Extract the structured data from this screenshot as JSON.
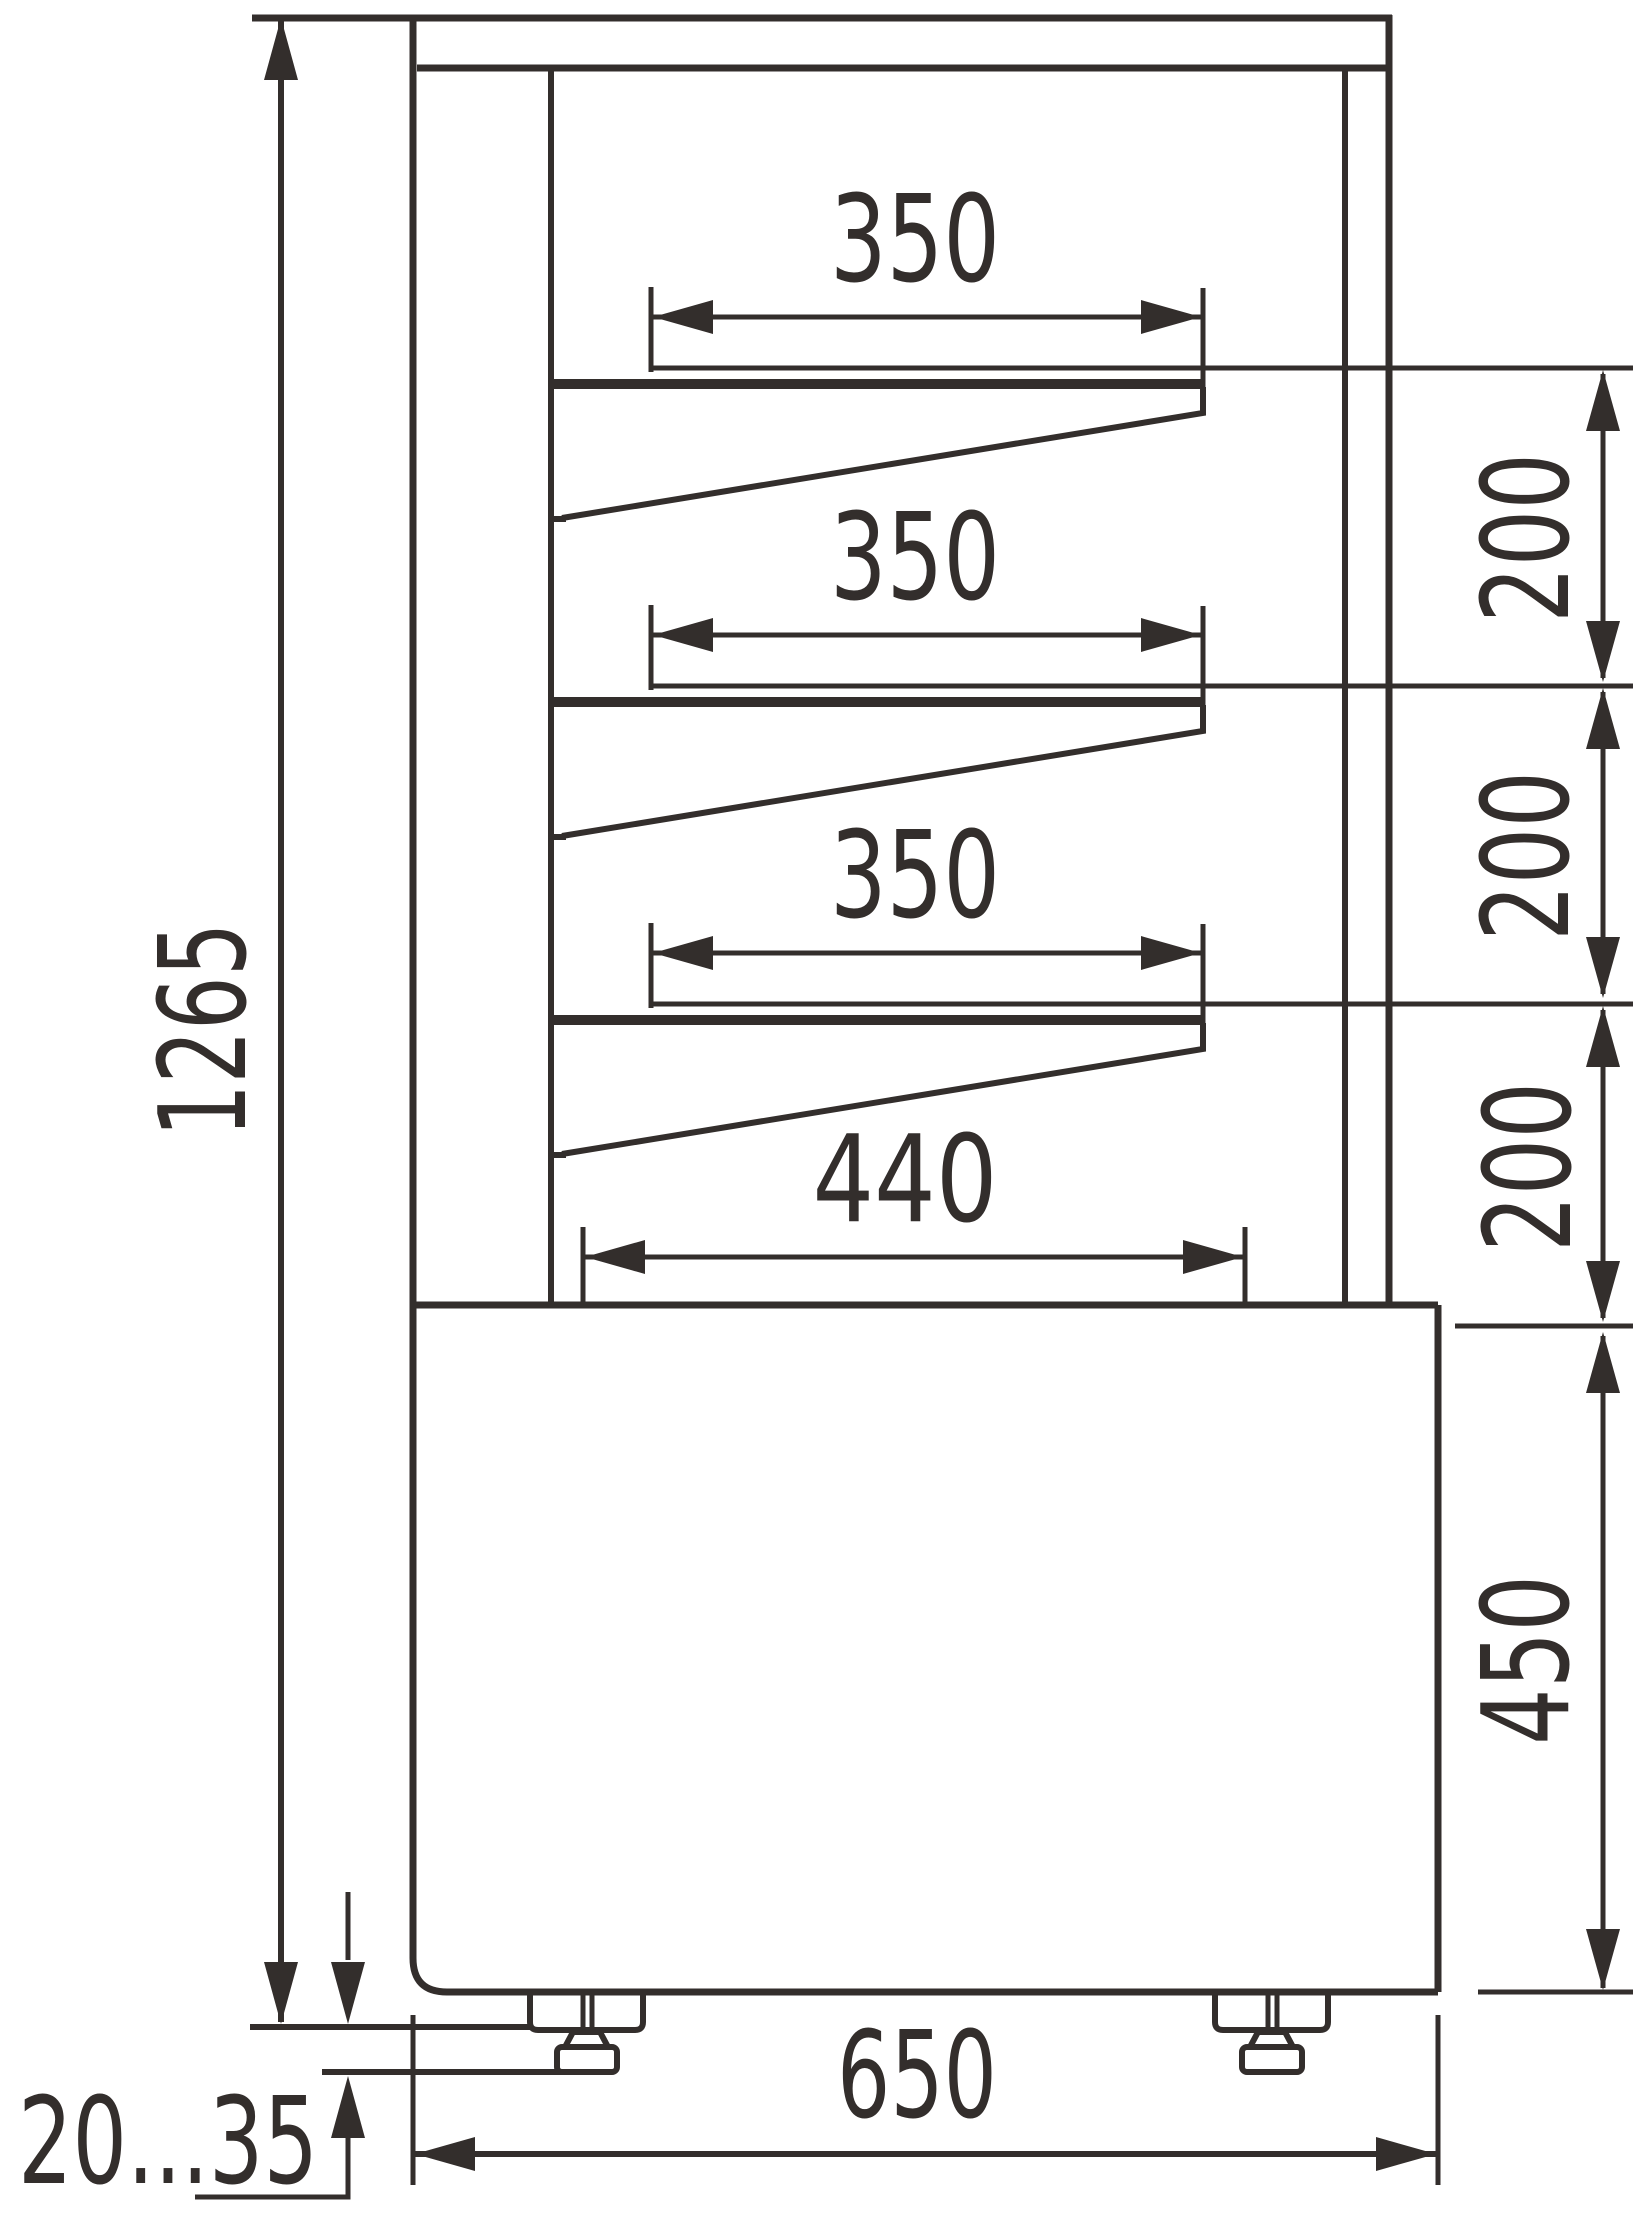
{
  "drawing": {
    "type": "technical-drawing",
    "subject": "display-case side section with shelves, base cabinet and adjustable feet",
    "units": "mm",
    "line_color": "#332e2c",
    "background_color": "#ffffff",
    "dims": {
      "total_height": "1265",
      "shelf_depths": [
        "350",
        "350",
        "350"
      ],
      "shelf_spacings": [
        "200",
        "200",
        "200"
      ],
      "bottom_shelf_depth": "440",
      "base_height": "450",
      "overall_depth": "650",
      "leg_height_range": "20...35"
    }
  }
}
